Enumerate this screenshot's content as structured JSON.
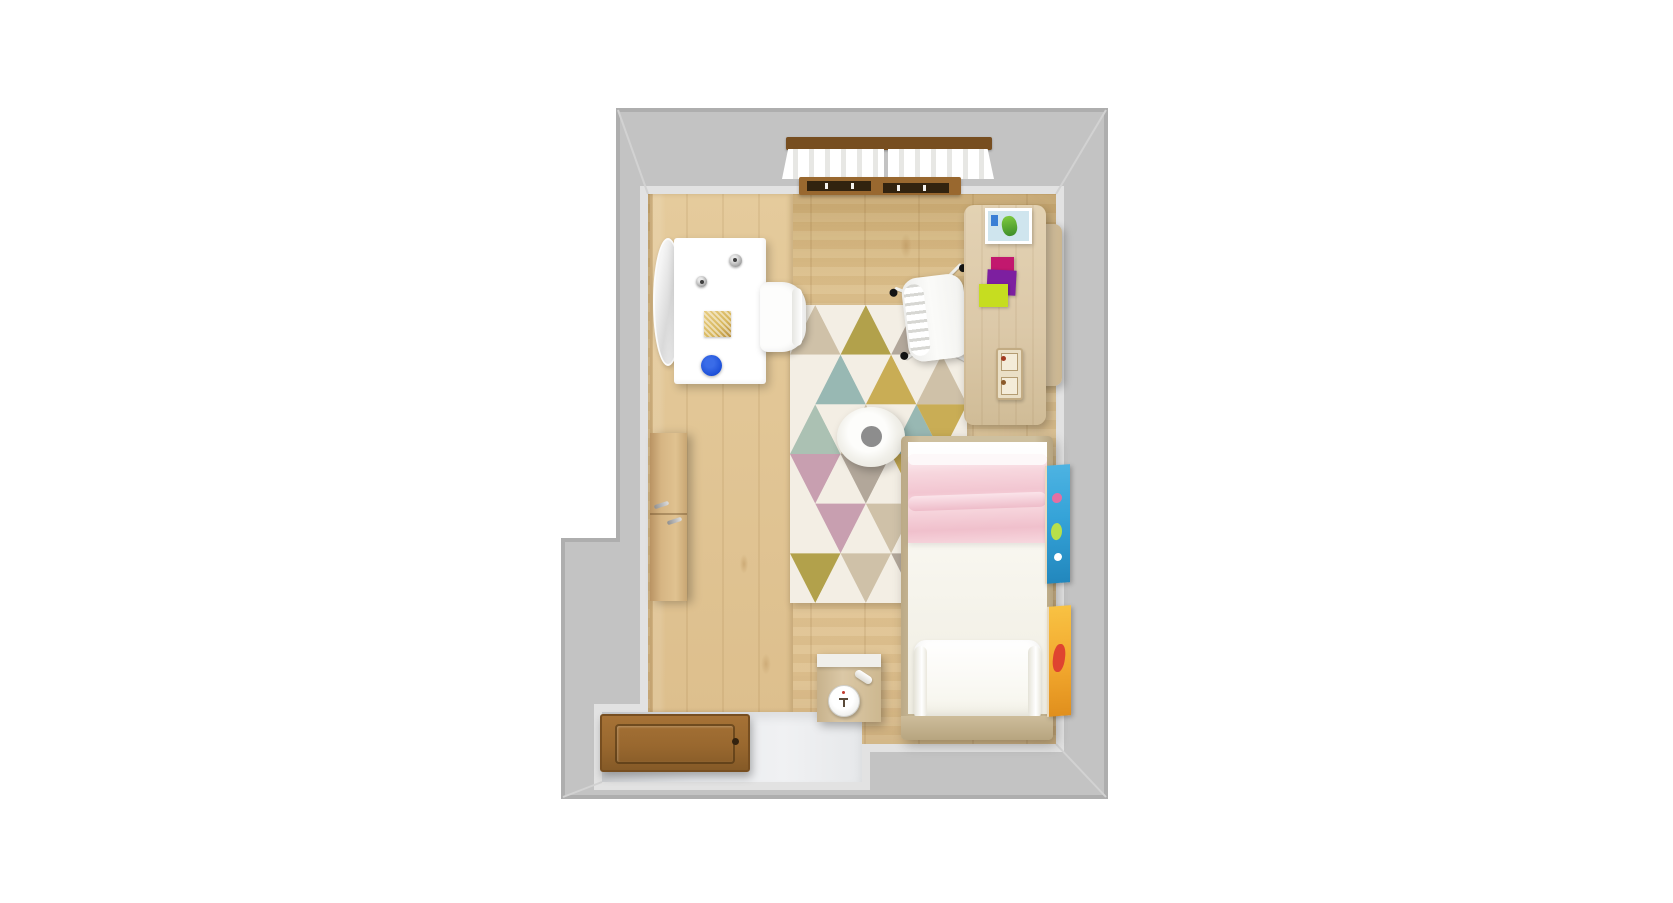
{
  "scene": {
    "view": "top-down 3d interior render",
    "room": "kids bedroom floor plan"
  },
  "palette": {
    "wall": "#c3c3c3",
    "wall_edge": "#e4e4e4",
    "wall_outer": "#adadad",
    "floor": "#ddbf8d",
    "floor_light": "#e5cb9c",
    "floor_dark": "#d3b47c",
    "entry": "#e9ebee",
    "rug_base": "#f3eee4",
    "wood": "#dcc9a9",
    "wardrobe": "#d6b583",
    "bedframe": "#cec09f",
    "mattress": "#f8f6ef",
    "blanket": "#f7d7de",
    "door": "#99682f",
    "door_edge": "#774e20",
    "gold": "#d8b85f",
    "blue": "#1d50d8",
    "magenta": "#c2186e",
    "purple": "#7d1fa0",
    "lime": "#c6dd20",
    "posterA": "#35a3d8",
    "posterB": "#f2a82e",
    "poster_red": "#df4430",
    "clockface": "#f2f2f0",
    "pouf_center": "#8d8d8d"
  },
  "rug": {
    "x": 790,
    "y": 305,
    "width": 177,
    "height": 298,
    "rows": 6,
    "cols": 6,
    "colors": {
      "cream": "#f3eee4",
      "tan": "#cfc1a8",
      "olive": "#b2a14b",
      "mustard": "#c9ad55",
      "sage": "#abc1b3",
      "teal": "#98b8b3",
      "pink": "#c89fb0",
      "gray": "#b2a79a"
    },
    "matrix": [
      [
        "tan",
        "cream",
        "olive",
        "cream",
        "gray",
        "cream"
      ],
      [
        "cream",
        "teal",
        "cream",
        "mustard",
        "cream",
        "tan"
      ],
      [
        "sage",
        "cream",
        "tan",
        "cream",
        "teal",
        "mustard"
      ],
      [
        "pink",
        "cream",
        "gray",
        "cream",
        "mustard",
        "cream"
      ],
      [
        "cream",
        "pink",
        "cream",
        "tan",
        "cream",
        "teal"
      ],
      [
        "olive",
        "cream",
        "tan",
        "cream",
        "gray",
        "cream"
      ]
    ]
  },
  "items": {
    "walls": {
      "label": "room walls"
    },
    "wood_floor": {
      "label": "wooden floor"
    },
    "entry_floor": {
      "label": "entry floor"
    },
    "window": {
      "label": "window with white curtains"
    },
    "door": {
      "label": "open wooden door"
    },
    "wardrobe": {
      "label": "wardrobe with handles"
    },
    "mirror": {
      "label": "round wall mirror"
    },
    "vanity": {
      "label": "white vanity desk"
    },
    "vanity_chair": {
      "label": "white vanity chair"
    },
    "desk": {
      "label": "wooden study desk"
    },
    "desk_hutch": {
      "label": "desk side return"
    },
    "desk_chair": {
      "label": "white swivel desk chair"
    },
    "picture": {
      "label": "picture with green figure"
    },
    "papers": {
      "label": "colored papers"
    },
    "organizer": {
      "label": "desk organizer"
    },
    "rug": {
      "label": "triangle pattern rug"
    },
    "pouf": {
      "label": "round white pouf"
    },
    "bed": {
      "label": "single bed with pink blanket"
    },
    "nightstand": {
      "label": "nightstand with alarm clock"
    },
    "poster_blue": {
      "label": "blue wall poster"
    },
    "poster_orange": {
      "label": "orange wall poster"
    }
  }
}
